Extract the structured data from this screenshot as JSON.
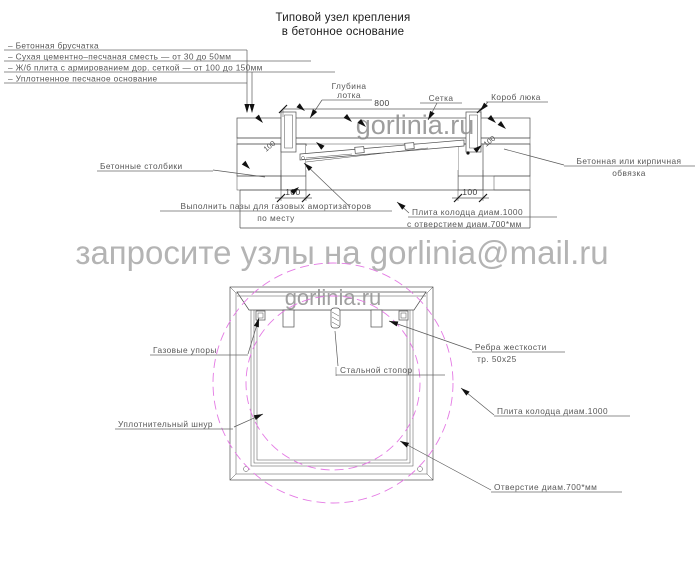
{
  "title": {
    "line1": "Типовой узел крепления",
    "line2": "в бетонное основание"
  },
  "legend": {
    "items": [
      "–  Бетонная брусчатка",
      "–  Сухая цементно–песчаная сместь — от 30 до 50мм",
      "–  Ж/б плита с армированием дор. сеткой — от 100 до 150мм",
      "–  Уплотненное песчаное основание"
    ]
  },
  "watermarks": {
    "email_line": "запросите узлы на gorlinia@mail.ru",
    "site_section": "gorlinia.ru",
    "site_plan": "gorlinia.ru"
  },
  "section": {
    "labels": {
      "glubina_1": "Глубина",
      "glubina_2": "лотка",
      "setka": "Сетка",
      "korob": "Короб люка",
      "stolbiki": "Бетонные столбики",
      "obvyazka_1": "Бетонная или кирпичная",
      "obvyazka_2": "обвязка",
      "pazy_1": "Выполнить пазы для газовых амортизаторов",
      "pazy_2": "по месту",
      "plita_1": "Плита колодца диам.1000",
      "plita_2": "с отверстием диам.700*мм"
    },
    "dims": {
      "d800": "800",
      "d100_left": "100",
      "d100_right": "100",
      "d100_rot_left": "100",
      "d100_rot_right": "100"
    }
  },
  "plan": {
    "labels": {
      "gazovye": "Газовые упоры",
      "stopor": "Стальной стопор",
      "rebra_1": "Ребра жесткости",
      "rebra_2": "тр. 50х25",
      "plita": "Плита колодца диам.1000",
      "shnur": "Уплотнительный шнур",
      "otverstie": "Отверстие диам.700*мм"
    }
  },
  "colors": {
    "line": "#4f4f4f",
    "line_dark": "#161616",
    "label": "#575757",
    "wm_big": "#b4b4b4",
    "wm_small": "#8d8d8d",
    "magenta": "#e47ae4"
  }
}
